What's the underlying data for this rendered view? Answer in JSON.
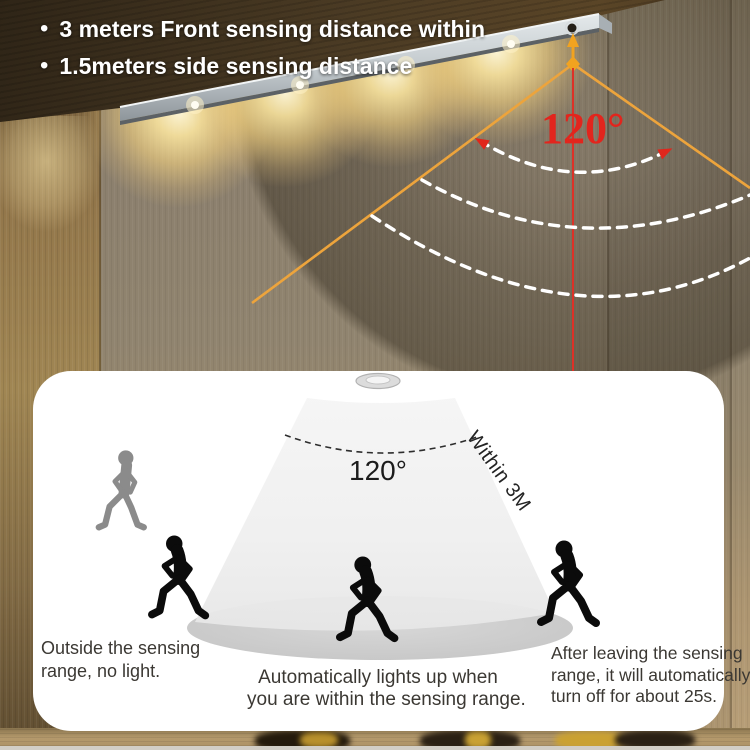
{
  "header": {
    "bullet_char": "•",
    "lines": [
      "3 meters Front sensing distance within",
      "1.5meters side sensing distance"
    ]
  },
  "overlay": {
    "angle_label": "120°",
    "colors": {
      "line_orange": "#EEA43C",
      "label_red": "#E2251D",
      "arc_white": "#FFFFFF"
    }
  },
  "panel": {
    "angle_label": "120°",
    "range_label": "Within 3M",
    "captions": {
      "left": [
        "Outside the sensing",
        "range, no light."
      ],
      "center": [
        "Automatically lights up when",
        "you are within the sensing range."
      ],
      "right": [
        "After leaving the sensing",
        "range, it will automatically",
        "turn off for about 25s."
      ]
    }
  }
}
